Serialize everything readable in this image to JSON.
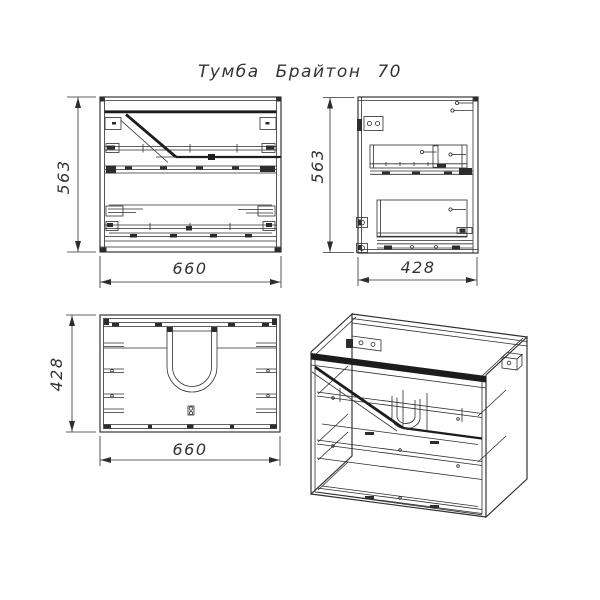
{
  "title": "Тумба Брайтон 70",
  "colors": {
    "line": "#2d2d2d",
    "background": "#ffffff"
  },
  "dimensions": {
    "front_height": "563",
    "front_width": "660",
    "side_height": "563",
    "side_depth": "428",
    "top_depth": "428",
    "top_width": "660"
  }
}
